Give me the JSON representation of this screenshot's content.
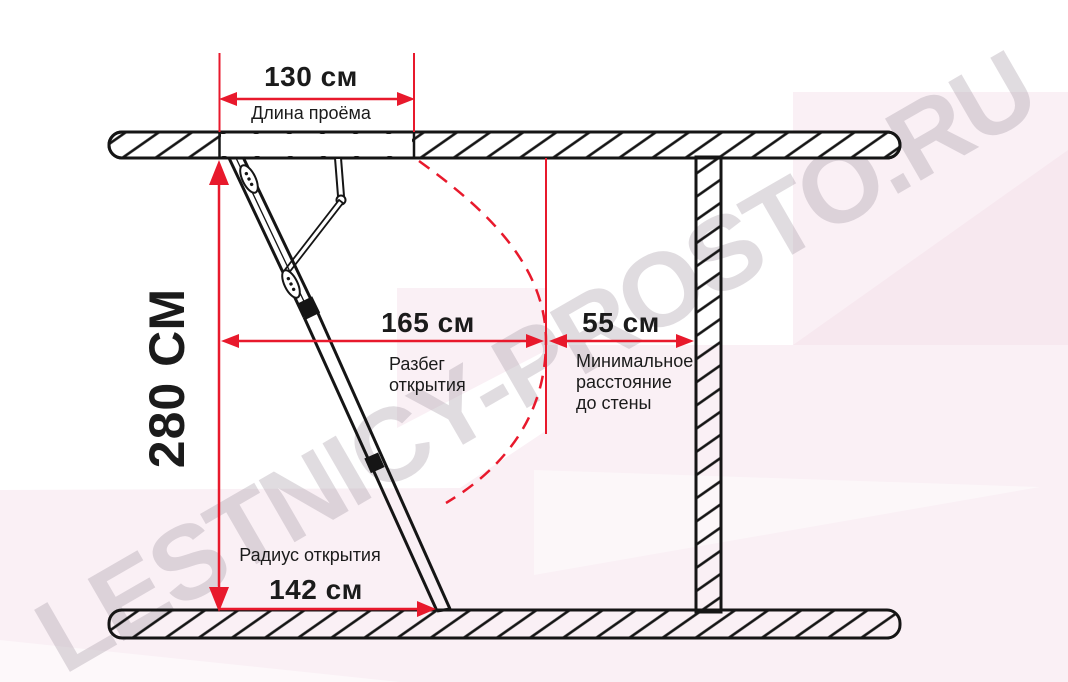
{
  "watermark": {
    "text": "LESTNICY-PROSTO.RU"
  },
  "colors": {
    "dimension_red": "#e8192c",
    "line_black": "#151515",
    "background_pink_light": "#faf0f5",
    "background_pink_dark": "#f7e8ef"
  },
  "dimensions": {
    "opening_length": {
      "value": "130 см",
      "label": "Длина проёма"
    },
    "room_height": {
      "value": "280 СМ"
    },
    "opening_span": {
      "value": "165 см",
      "label": "Разбег\nоткрытия"
    },
    "min_wall_distance": {
      "value": "55 см",
      "label": "Минимальное\nрасстояние\nдо стены"
    },
    "opening_radius": {
      "value": "142 см",
      "label": "Радиус открытия"
    }
  }
}
